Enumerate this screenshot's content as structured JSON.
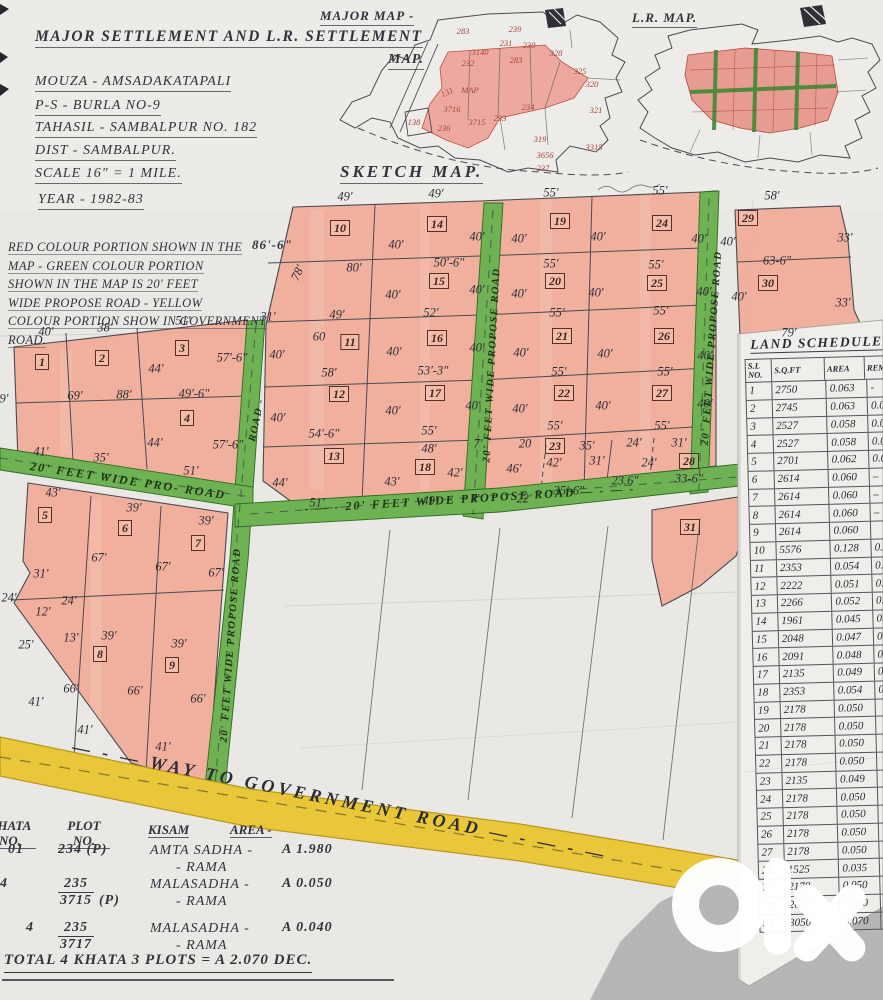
{
  "header": {
    "title_line1": "MAJOR SETTLEMENT AND L.R. SETTLEMENT",
    "title_line2": "MAP.",
    "mouza": "MOUZA - AMSADAKATAPALI",
    "ps": "P-S - BURLA NO-9",
    "tahasil": "TAHASIL - SAMBALPUR NO. 182",
    "dist": "DIST - SAMBALPUR.",
    "scale": "SCALE 16\" = 1 MILE.",
    "year": "YEAR - 1982-83"
  },
  "notes": {
    "lines": [
      "RED COLOUR PORTION SHOWN IN THE",
      "MAP - GREEN COLOUR PORTION",
      "SHOWN IN THE MAP IS 20' FEET",
      "WIDE PROPOSE ROAD - YELLOW",
      "COLOUR PORTION SHOW IN GOVERNMENT",
      "ROAD."
    ],
    "annotation": "86'-6\""
  },
  "mini_maps": {
    "major_map_label": "MAJOR MAP -",
    "lr_map_label": "L.R. MAP.",
    "major_map_numbers": [
      {
        "t": "283",
        "x": 463,
        "y": 31
      },
      {
        "t": "239",
        "x": 515,
        "y": 29
      },
      {
        "t": "3140",
        "x": 480,
        "y": 52
      },
      {
        "t": "231",
        "x": 506,
        "y": 43
      },
      {
        "t": "230",
        "x": 529,
        "y": 45
      },
      {
        "t": "232",
        "x": 468,
        "y": 63
      },
      {
        "t": "283",
        "x": 516,
        "y": 60
      },
      {
        "t": "328",
        "x": 556,
        "y": 53
      },
      {
        "t": "325",
        "x": 580,
        "y": 71
      },
      {
        "t": "320",
        "x": 592,
        "y": 84
      },
      {
        "t": "131",
        "x": 447,
        "y": 92,
        "r": -25
      },
      {
        "t": "MAP",
        "x": 470,
        "y": 90
      },
      {
        "t": "138",
        "x": 414,
        "y": 122
      },
      {
        "t": "3716",
        "x": 452,
        "y": 109
      },
      {
        "t": "236",
        "x": 444,
        "y": 128
      },
      {
        "t": "3715",
        "x": 477,
        "y": 122
      },
      {
        "t": "233",
        "x": 500,
        "y": 118
      },
      {
        "t": "234",
        "x": 528,
        "y": 107
      },
      {
        "t": "321",
        "x": 596,
        "y": 110
      },
      {
        "t": "319",
        "x": 540,
        "y": 139
      },
      {
        "t": "3656",
        "x": 545,
        "y": 155
      },
      {
        "t": "237",
        "x": 543,
        "y": 168
      },
      {
        "t": "3315",
        "x": 594,
        "y": 147
      }
    ]
  },
  "sketch": {
    "heading": "SKETCH MAP.",
    "plot_boxes": [
      {
        "n": "1",
        "x": 42,
        "y": 362
      },
      {
        "n": "2",
        "x": 102,
        "y": 358
      },
      {
        "n": "3",
        "x": 182,
        "y": 348
      },
      {
        "n": "4",
        "x": 187,
        "y": 418
      },
      {
        "n": "5",
        "x": 45,
        "y": 515
      },
      {
        "n": "6",
        "x": 125,
        "y": 528
      },
      {
        "n": "7",
        "x": 198,
        "y": 543
      },
      {
        "n": "8",
        "x": 100,
        "y": 654
      },
      {
        "n": "9",
        "x": 172,
        "y": 665
      },
      {
        "n": "10",
        "x": 340,
        "y": 228
      },
      {
        "n": "11",
        "x": 350,
        "y": 342
      },
      {
        "n": "12",
        "x": 339,
        "y": 394
      },
      {
        "n": "13",
        "x": 334,
        "y": 456
      },
      {
        "n": "14",
        "x": 437,
        "y": 224
      },
      {
        "n": "15",
        "x": 439,
        "y": 281
      },
      {
        "n": "16",
        "x": 437,
        "y": 338
      },
      {
        "n": "17",
        "x": 435,
        "y": 393
      },
      {
        "n": "18",
        "x": 425,
        "y": 467
      },
      {
        "n": "19",
        "x": 560,
        "y": 221
      },
      {
        "n": "20",
        "x": 555,
        "y": 281
      },
      {
        "n": "21",
        "x": 562,
        "y": 336
      },
      {
        "n": "22",
        "x": 564,
        "y": 393
      },
      {
        "n": "23",
        "x": 555,
        "y": 446
      },
      {
        "n": "24",
        "x": 662,
        "y": 223
      },
      {
        "n": "25",
        "x": 657,
        "y": 283
      },
      {
        "n": "26",
        "x": 664,
        "y": 336
      },
      {
        "n": "27",
        "x": 662,
        "y": 393
      },
      {
        "n": "28",
        "x": 689,
        "y": 461
      },
      {
        "n": "29",
        "x": 748,
        "y": 218
      },
      {
        "n": "30",
        "x": 768,
        "y": 283
      },
      {
        "n": "31",
        "x": 690,
        "y": 527
      }
    ],
    "dim_labels": [
      {
        "t": "49'",
        "x": 345,
        "y": 197
      },
      {
        "t": "49'",
        "x": 436,
        "y": 194
      },
      {
        "t": "55'",
        "x": 551,
        "y": 193
      },
      {
        "t": "55'",
        "x": 660,
        "y": 191
      },
      {
        "t": "58'",
        "x": 772,
        "y": 196
      },
      {
        "t": "40'",
        "x": 396,
        "y": 245
      },
      {
        "t": "40'",
        "x": 477,
        "y": 237
      },
      {
        "t": "40'",
        "x": 519,
        "y": 239
      },
      {
        "t": "40'",
        "x": 598,
        "y": 237
      },
      {
        "t": "40'",
        "x": 699,
        "y": 239
      },
      {
        "t": "40'",
        "x": 728,
        "y": 242
      },
      {
        "t": "33'",
        "x": 845,
        "y": 238
      },
      {
        "t": "78'",
        "x": 298,
        "y": 273,
        "r": -65
      },
      {
        "t": "80'",
        "x": 354,
        "y": 268
      },
      {
        "t": "50'-6\"",
        "x": 449,
        "y": 263
      },
      {
        "t": "55'",
        "x": 551,
        "y": 264
      },
      {
        "t": "55'",
        "x": 656,
        "y": 265
      },
      {
        "t": "63-6\"",
        "x": 777,
        "y": 261
      },
      {
        "t": "40'",
        "x": 393,
        "y": 295
      },
      {
        "t": "40'",
        "x": 477,
        "y": 290
      },
      {
        "t": "40'",
        "x": 519,
        "y": 294
      },
      {
        "t": "40'",
        "x": 596,
        "y": 293
      },
      {
        "t": "40'",
        "x": 704,
        "y": 292
      },
      {
        "t": "40'",
        "x": 739,
        "y": 297
      },
      {
        "t": "33'",
        "x": 843,
        "y": 303
      },
      {
        "t": "49'",
        "x": 337,
        "y": 315
      },
      {
        "t": "52'",
        "x": 431,
        "y": 313
      },
      {
        "t": "55'",
        "x": 557,
        "y": 313
      },
      {
        "t": "55'",
        "x": 661,
        "y": 311
      },
      {
        "t": "79'",
        "x": 789,
        "y": 333
      },
      {
        "t": "60",
        "x": 319,
        "y": 337
      },
      {
        "t": "40'",
        "x": 277,
        "y": 355
      },
      {
        "t": "40'",
        "x": 394,
        "y": 352
      },
      {
        "t": "40'",
        "x": 477,
        "y": 348
      },
      {
        "t": "40'",
        "x": 521,
        "y": 353
      },
      {
        "t": "40'",
        "x": 605,
        "y": 354
      },
      {
        "t": "40'",
        "x": 705,
        "y": 356
      },
      {
        "t": "58'",
        "x": 329,
        "y": 373
      },
      {
        "t": "53'-3\"",
        "x": 433,
        "y": 371
      },
      {
        "t": "55'",
        "x": 559,
        "y": 372
      },
      {
        "t": "55'",
        "x": 665,
        "y": 372
      },
      {
        "t": "40'",
        "x": 278,
        "y": 418
      },
      {
        "t": "40'",
        "x": 393,
        "y": 411
      },
      {
        "t": "40'",
        "x": 473,
        "y": 406
      },
      {
        "t": "40'",
        "x": 520,
        "y": 409
      },
      {
        "t": "40'",
        "x": 603,
        "y": 406
      },
      {
        "t": "40'",
        "x": 705,
        "y": 404
      },
      {
        "t": "54'-6\"",
        "x": 324,
        "y": 434
      },
      {
        "t": "55'",
        "x": 429,
        "y": 431
      },
      {
        "t": "55'",
        "x": 555,
        "y": 426
      },
      {
        "t": "55'",
        "x": 662,
        "y": 426
      },
      {
        "t": "48'",
        "x": 429,
        "y": 449
      },
      {
        "t": "7'",
        "x": 478,
        "y": 444
      },
      {
        "t": "20",
        "x": 525,
        "y": 444
      },
      {
        "t": "35'",
        "x": 587,
        "y": 446
      },
      {
        "t": "24'",
        "x": 634,
        "y": 443
      },
      {
        "t": "31'",
        "x": 679,
        "y": 443
      },
      {
        "t": "44'",
        "x": 280,
        "y": 483
      },
      {
        "t": "43'",
        "x": 392,
        "y": 482
      },
      {
        "t": "42'",
        "x": 455,
        "y": 473
      },
      {
        "t": "46'",
        "x": 514,
        "y": 469
      },
      {
        "t": "42'",
        "x": 554,
        "y": 463
      },
      {
        "t": "31'",
        "x": 597,
        "y": 461
      },
      {
        "t": "24'",
        "x": 649,
        "y": 463
      },
      {
        "t": "23.6\"",
        "x": 625,
        "y": 481
      },
      {
        "t": "33-6\"",
        "x": 689,
        "y": 479
      },
      {
        "t": "51'",
        "x": 317,
        "y": 503
      },
      {
        "t": "49'",
        "x": 430,
        "y": 501
      },
      {
        "t": "7'",
        "x": 475,
        "y": 499
      },
      {
        "t": "22'",
        "x": 524,
        "y": 499
      },
      {
        "t": "35'-6\"",
        "x": 569,
        "y": 491
      },
      {
        "t": "40'",
        "x": 46,
        "y": 332
      },
      {
        "t": "38'",
        "x": 105,
        "y": 328
      },
      {
        "t": "51'",
        "x": 183,
        "y": 321
      },
      {
        "t": "31'",
        "x": 268,
        "y": 317
      },
      {
        "t": "44'",
        "x": 156,
        "y": 369
      },
      {
        "t": "57'-6\"",
        "x": 232,
        "y": 358
      },
      {
        "t": "69'",
        "x": 75,
        "y": 396
      },
      {
        "t": "88'",
        "x": 124,
        "y": 395
      },
      {
        "t": "49'-6\"",
        "x": 194,
        "y": 394
      },
      {
        "t": "9'",
        "x": 4,
        "y": 399
      },
      {
        "t": "44'",
        "x": 155,
        "y": 443
      },
      {
        "t": "57'-6\"",
        "x": 228,
        "y": 445
      },
      {
        "t": "41'",
        "x": 41,
        "y": 452
      },
      {
        "t": "35'",
        "x": 101,
        "y": 458
      },
      {
        "t": "51'",
        "x": 191,
        "y": 471
      },
      {
        "t": "43'",
        "x": 53,
        "y": 493
      },
      {
        "t": "39'",
        "x": 134,
        "y": 508
      },
      {
        "t": "39'",
        "x": 206,
        "y": 521
      },
      {
        "t": "67'",
        "x": 99,
        "y": 558
      },
      {
        "t": "67'",
        "x": 163,
        "y": 567
      },
      {
        "t": "67'",
        "x": 216,
        "y": 573
      },
      {
        "t": "31'",
        "x": 41,
        "y": 574
      },
      {
        "t": "24'",
        "x": 9,
        "y": 598
      },
      {
        "t": "24'",
        "x": 69,
        "y": 601
      },
      {
        "t": "12'",
        "x": 43,
        "y": 612
      },
      {
        "t": "25'",
        "x": 26,
        "y": 645
      },
      {
        "t": "13'",
        "x": 71,
        "y": 638
      },
      {
        "t": "39'",
        "x": 109,
        "y": 636
      },
      {
        "t": "39'",
        "x": 179,
        "y": 644
      },
      {
        "t": "66'",
        "x": 71,
        "y": 689
      },
      {
        "t": "66'",
        "x": 135,
        "y": 691
      },
      {
        "t": "66'",
        "x": 198,
        "y": 699
      },
      {
        "t": "41'",
        "x": 36,
        "y": 702
      },
      {
        "t": "41'",
        "x": 85,
        "y": 730
      },
      {
        "t": "41'",
        "x": 163,
        "y": 747
      }
    ],
    "road_labels": [
      {
        "t": "20' FEET WIDE PROPOSE ROAD",
        "x": 492,
        "y": 365,
        "r": -87,
        "cls": "v"
      },
      {
        "t": "20' FEET WIDE PROPOSE ROAD",
        "x": 712,
        "y": 348,
        "r": -86,
        "cls": "v"
      },
      {
        "t": "20' FEET WIDE PROPOSE ROAD",
        "x": 231,
        "y": 645,
        "r": -86,
        "cls": "v"
      },
      {
        "t": "ROAD -",
        "x": 257,
        "y": 420,
        "r": -78,
        "cls": "v"
      },
      {
        "t": "- — - 20' FEET WIDE PROPOSE ROAD — - — -",
        "x": 470,
        "y": 499,
        "r": -3.5,
        "cls": "h"
      },
      {
        "t": "20' FEET WIDE PRO- ROAD",
        "x": 128,
        "y": 481,
        "r": 8.5,
        "cls": "h"
      },
      {
        "t": "— - — WAY TO GOVERNMENT ROAD — - — - —",
        "x": 340,
        "y": 801,
        "r": 11.5,
        "cls": "y"
      }
    ]
  },
  "schedule": {
    "title": "LAND SCHEDULE",
    "columns": [
      "S.L NO.",
      "S.Q.FT",
      "AREA",
      "REM"
    ],
    "rows": [
      [
        "1",
        "2750",
        "0.063",
        "-"
      ],
      [
        "2",
        "2745",
        "0.063",
        "0.06"
      ],
      [
        "3",
        "2527",
        "0.058",
        "0.0"
      ],
      [
        "4",
        "2527",
        "0.058",
        "0.0"
      ],
      [
        "5",
        "2701",
        "0.062",
        "0.0"
      ],
      [
        "6",
        "2614",
        "0.060",
        "–"
      ],
      [
        "7",
        "2614",
        "0.060",
        "–"
      ],
      [
        "8",
        "2614",
        "0.060",
        "–"
      ],
      [
        "9",
        "2614",
        "0.060",
        ""
      ],
      [
        "10",
        "5576",
        "0.128",
        "0.13"
      ],
      [
        "11",
        "2353",
        "0.054",
        "0.0"
      ],
      [
        "12",
        "2222",
        "0.051",
        "0.0"
      ],
      [
        "13",
        "2266",
        "0.052",
        "0.0"
      ],
      [
        "14",
        "1961",
        "0.045",
        "0.0"
      ],
      [
        "15",
        "2048",
        "0.047",
        "0."
      ],
      [
        "16",
        "2091",
        "0.048",
        "0."
      ],
      [
        "17",
        "2135",
        "0.049",
        "0."
      ],
      [
        "18",
        "2353",
        "0.054",
        "0."
      ],
      [
        "19",
        "2178",
        "0.050",
        ""
      ],
      [
        "20",
        "2178",
        "0.050",
        ""
      ],
      [
        "21",
        "2178",
        "0.050",
        ""
      ],
      [
        "22",
        "2178",
        "0.050",
        ""
      ],
      [
        "23",
        "2135",
        "0.049",
        ""
      ],
      [
        "24",
        "2178",
        "0.050",
        ""
      ],
      [
        "25",
        "2178",
        "0.050",
        ""
      ],
      [
        "26",
        "2178",
        "0.050",
        ""
      ],
      [
        "27",
        "2178",
        "0.050",
        ""
      ],
      [
        "28",
        "1525",
        "0.035",
        ""
      ],
      [
        "29",
        "2178",
        "0.050",
        ""
      ],
      [
        "30",
        "2614",
        "0.060",
        ""
      ],
      [
        "31",
        "3050",
        "0.070",
        ""
      ]
    ]
  },
  "khata_table": {
    "headers": [
      "KHATA NO.",
      "PLOT NO.",
      "KISAM",
      "AREA -"
    ],
    "rows": [
      {
        "y": 26,
        "kx": 8,
        "khata": "01",
        "plot": "234 (P)",
        "num": "",
        "den": "",
        "suf": "",
        "kisam1": "AMTA SADHA -",
        "kisam2": "- RAMA",
        "area": "A 1.980"
      },
      {
        "y": 60,
        "kx": 0,
        "khata": "4",
        "plot": "",
        "num": "235",
        "den": "3715",
        "suf": "(P)",
        "kisam1": "MALASADHA -",
        "kisam2": "- RAMA",
        "area": "A 0.050"
      },
      {
        "y": 104,
        "kx": 26,
        "khata": "4",
        "plot": "",
        "num": "235",
        "den": "3717",
        "suf": "",
        "kisam1": "MALASADHA -",
        "kisam2": "- RAMA",
        "area": "A 0.040"
      }
    ],
    "total": "TOTAL 4 KHATA 3 PLOTS  =  A 2.070 DEC."
  },
  "watermark": {
    "brand": "olx"
  },
  "colors": {
    "paper": "#e9e8e4",
    "plot_red": "#f2a48e",
    "road_green": "#6fb254",
    "road_yellow": "#e9c738",
    "ink": "#32323c",
    "red_ink": "#a8443a",
    "table_gray": "#b4b7b6"
  }
}
